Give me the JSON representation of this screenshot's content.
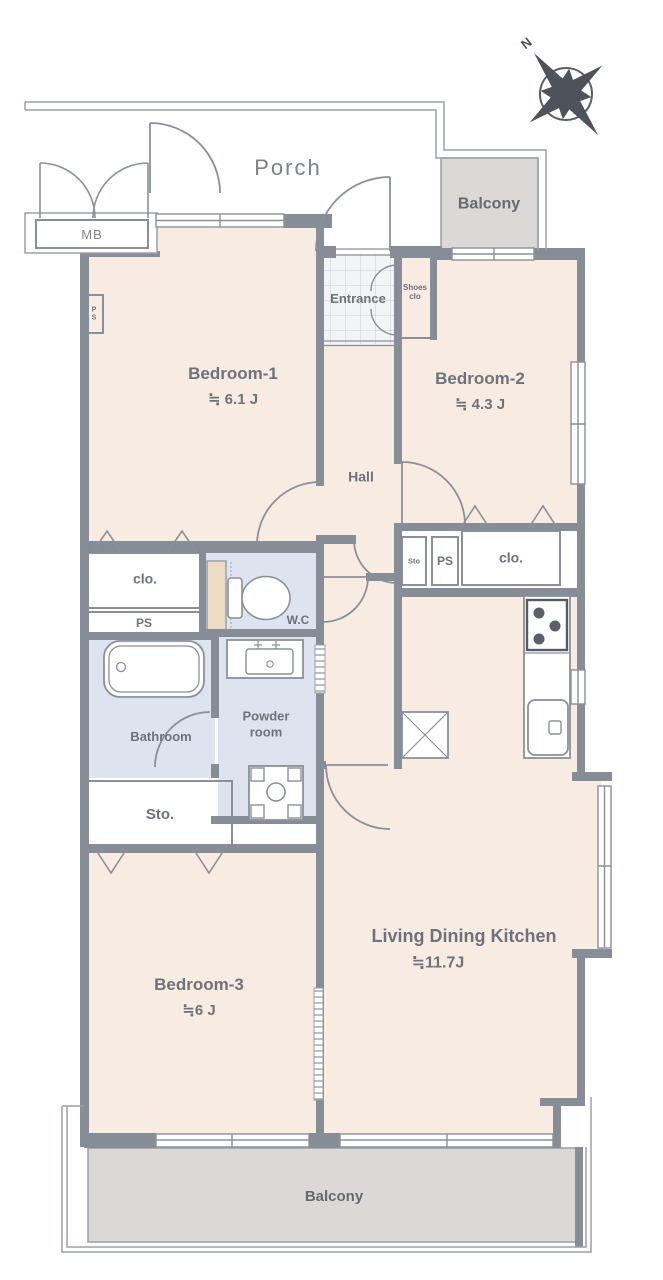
{
  "plan": {
    "compass": {
      "north_label": "N"
    },
    "porch_label": "Porch",
    "meter_box_label": "MB",
    "balcony_top_label": "Balcony",
    "balcony_bottom_label": "Balcony",
    "entrance_label": "Entrance",
    "shoes_closet": {
      "line1": "Shoes",
      "line2": "clo"
    },
    "hall_label": "Hall",
    "wc_label": "W.C",
    "bathroom_label": "Bathroom",
    "powder_room": {
      "line1": "Powder",
      "line2": "room"
    },
    "storage_large_label": "Sto.",
    "storage_small_label": "Sto",
    "closet_left_label": "clo.",
    "closet_right_label": "clo.",
    "ps_left_label": "PS",
    "ps_right_label": "PS",
    "ps_tiny": {
      "line1": "P",
      "line2": "S"
    },
    "rooms": {
      "bedroom1": {
        "name": "Bedroom-1",
        "size": "≒ 6.1 J"
      },
      "bedroom2": {
        "name": "Bedroom-2",
        "size": "≒ 4.3 J"
      },
      "bedroom3": {
        "name": "Bedroom-3",
        "size": "≒6 J"
      },
      "ldk": {
        "name": "Living Dining Kitchen",
        "size": "≒11.7J"
      }
    },
    "colors": {
      "room_pink": "#f8ebe2",
      "closet_tan": "#e8d0a4",
      "wet_area_blue": "#dde4f0",
      "balcony_gray": "#dbd9d6",
      "wall_gray": "#878d97",
      "line_gray": "#8a909a",
      "text_gray": "#6d727b"
    }
  }
}
